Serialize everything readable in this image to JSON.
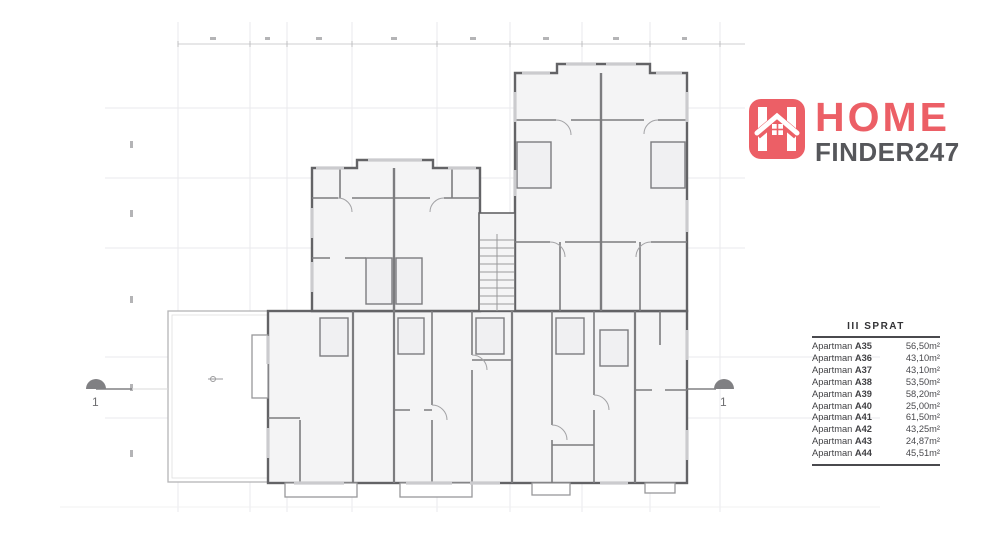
{
  "logo": {
    "brand_top": "HOME",
    "brand_bottom": "FINDER247",
    "icon": "home-finder-house-icon",
    "accent_color": "#ec5f66",
    "text_color": "#56575b"
  },
  "plan": {
    "section_cut_label_left": "1",
    "section_cut_label_right": "1"
  },
  "legend_table": {
    "title": "III SPRAT",
    "rows": [
      {
        "label": "Apartman",
        "unit": "A35",
        "area": "56,50m²"
      },
      {
        "label": "Apartman",
        "unit": "A36",
        "area": "43,10m²"
      },
      {
        "label": "Apartman",
        "unit": "A37",
        "area": "43,10m²"
      },
      {
        "label": "Apartman",
        "unit": "A38",
        "area": "53,50m²"
      },
      {
        "label": "Apartman",
        "unit": "A39",
        "area": "58,20m²"
      },
      {
        "label": "Apartman",
        "unit": "A40",
        "area": "25,00m²"
      },
      {
        "label": "Apartman",
        "unit": "A41",
        "area": "61,50m²"
      },
      {
        "label": "Apartman",
        "unit": "A42",
        "area": "43,25m²"
      },
      {
        "label": "Apartman",
        "unit": "A43",
        "area": "24,87m²"
      },
      {
        "label": "Apartman",
        "unit": "A44",
        "area": "45,51m²"
      }
    ]
  }
}
